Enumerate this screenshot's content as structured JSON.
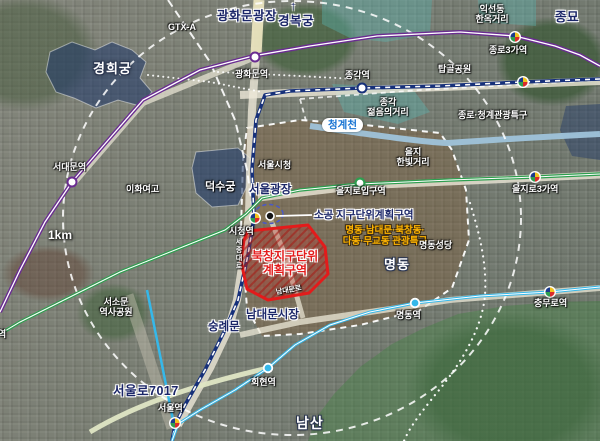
{
  "map": {
    "scale_label": "1km",
    "transit_label": "GTX-A",
    "palaces": {
      "gyeonghuigung": "경희궁",
      "gyeongbokgung": "경복궁",
      "gyeongbokgung_arrow": "↑",
      "deoksugung": "덕수궁",
      "jongmyo": "종묘"
    },
    "districts": {
      "bukchang_plan_zone": "북창지구단위\n계획구역",
      "sogong_plan_zone": "소공 지구단위계획구역",
      "jongno_cheonggye_tourist_zone": "종로·청계관광특구",
      "myeongdong_tourist_zone": "명동·남대문·북창동·\n다동·무교동 관광특구"
    },
    "places": {
      "gwanghwamun_plaza": "광화문광장",
      "ikseondong_hanok_street": "익선동\n한옥거리",
      "tapgol_park": "탑골공원",
      "jonggak_youth_street": "종각\n젊음의거리",
      "cheonggyecheon": "청계천",
      "seoul_city_hall": "서울시청",
      "seoul_plaza": "서울광장",
      "eulji_hanbit_street": "을지\n한빛거리",
      "ewha_girls_high_school": "이화여고",
      "myeongdong": "명동",
      "myeongdong_cathedral": "명동성당",
      "sungnyemun": "숭례문",
      "namdaemun_market": "남대문시장",
      "seosomun_history_park": "서소문\n역사공원",
      "seoullo_7017": "서울로7017",
      "namsan": "남산"
    },
    "roads": {
      "sejongdaero": "세종대로",
      "namdaemunro": "남대문로"
    },
    "stations": {
      "gwanghwamun": "광화문역",
      "seodaemun": "서대문역",
      "jonggak": "종각역",
      "jongno_3ga": "종로3가역",
      "euljiro_1ga": "을지로입구역",
      "euljiro_3ga": "을지로3가역",
      "city_hall": "시청역",
      "hoehyeon": "회현역",
      "myeongdong": "명동역",
      "chungmuro": "충무로역",
      "seoul": "서울역",
      "chungjeongno": "충정로역"
    },
    "colors": {
      "line1": "#16307a",
      "line2": "#2e9e4f",
      "line4": "#35b8ea",
      "line5": "#6a2c91",
      "plan_zone_red": "#e31b1b",
      "tourist_zone_yellow": "#ffb400",
      "label_navy": "#1b2668",
      "palace_fill": "#1e3769",
      "stream_blue": "#9fc3da"
    }
  }
}
